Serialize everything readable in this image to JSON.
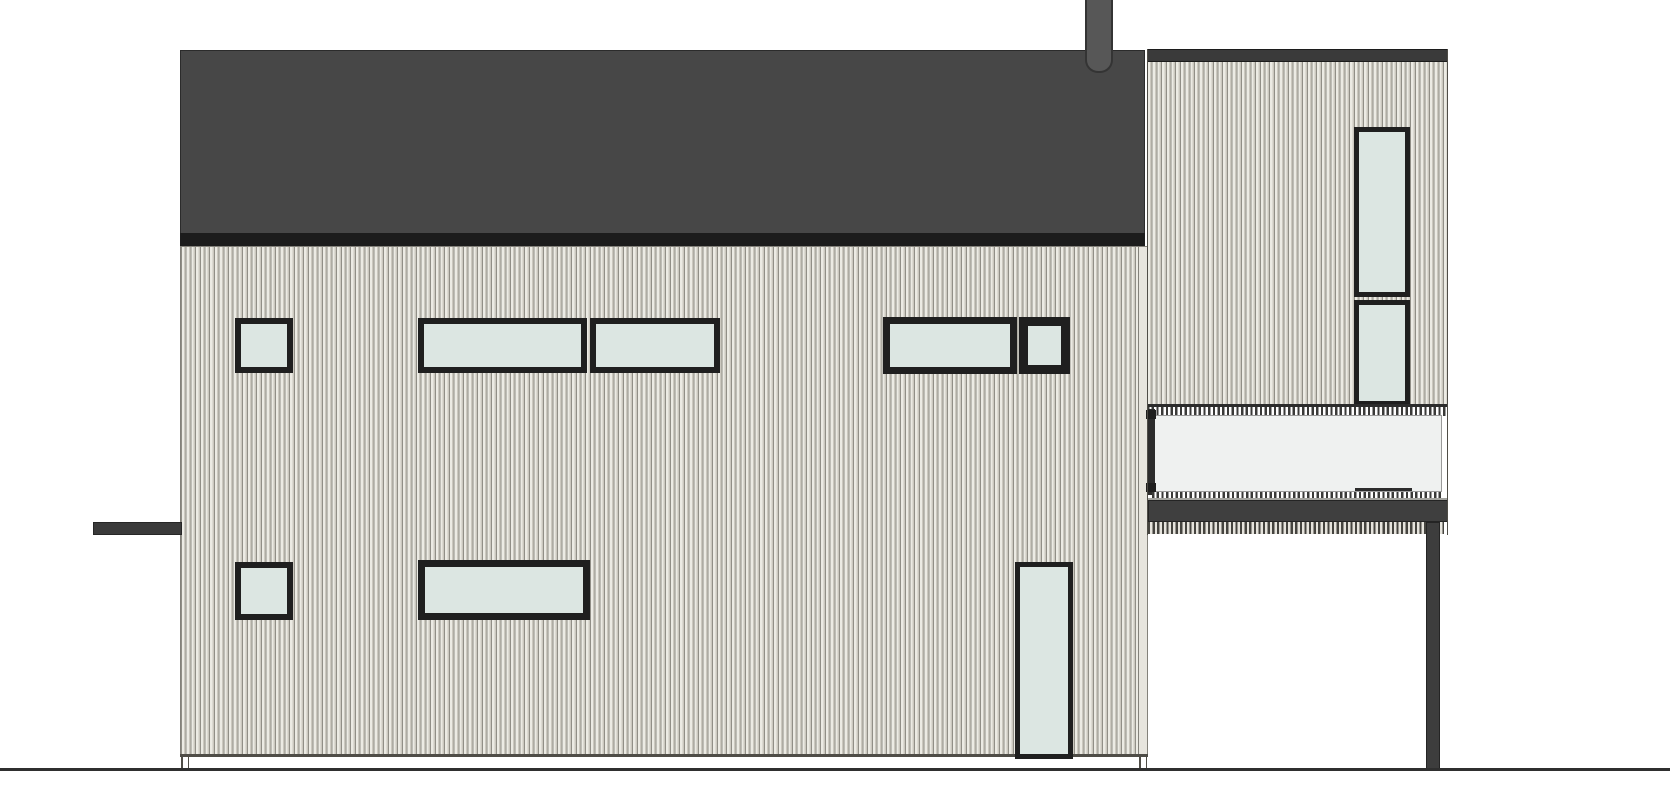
{
  "drawing": {
    "kind": "house-side-elevation",
    "canvas": {
      "width": 1670,
      "height": 800
    }
  },
  "colors": {
    "background": "#ffffff",
    "roof": "#474747",
    "roof_outline": "#2b2b2b",
    "fascia": "#1c1c1c",
    "dark_band": "#3a3a3a",
    "beam_outline": "#262626",
    "chimney": "#575757",
    "chimney_outline": "#343434",
    "wall_outline": "#83817a",
    "edge_dark": "#4f4d47",
    "corner_board": "#e7e5de",
    "window_frame": "#1f1f1f",
    "glass": "#dce6e2",
    "balcony_glass": "#eff1f0",
    "panel_edge": "#9a9a9a",
    "rail_dark": "#2c2c2c",
    "slab": "#3f3f3f",
    "slab_highlight": "#a3a39e",
    "post": "#3d3d3d",
    "post_outline": "#242424",
    "ground": "#2f2f2f",
    "white": "#ffffff",
    "siding_groove": "#918f87",
    "siding_light": "#ecebe4",
    "siding_shadow": "#cbc8bf"
  },
  "scene": {
    "elements": [
      {
        "name": "main-roof",
        "type": "rect",
        "x": 180,
        "y": 50,
        "w": 965,
        "h": 185,
        "fill": "roof",
        "line": "roof_outline",
        "lw": 1.5
      },
      {
        "name": "main-roof-fascia",
        "type": "rect",
        "x": 180,
        "y": 233,
        "w": 965,
        "h": 13,
        "fill": "fascia"
      },
      {
        "name": "main-facade-siding",
        "type": "siding",
        "x": 180,
        "y": 246,
        "w": 968,
        "h": 510,
        "line": "wall_outline",
        "lw": 1
      },
      {
        "name": "facade-corner-board",
        "type": "rect",
        "x": 1138,
        "y": 246,
        "w": 10,
        "h": 510,
        "fill": "corner_board",
        "line": "wall_outline",
        "lw": 1
      },
      {
        "name": "facade-bottom-edge",
        "type": "rect",
        "x": 180,
        "y": 754,
        "w": 968,
        "h": 2.5,
        "fill": "edge_dark"
      },
      {
        "name": "window-upper-square-left",
        "type": "window",
        "x": 235,
        "y": 318,
        "w": 58,
        "h": 55,
        "f": 6
      },
      {
        "name": "window-upper-wide-left-a",
        "type": "window",
        "x": 418,
        "y": 318,
        "w": 169,
        "h": 55,
        "f": 6
      },
      {
        "name": "window-upper-wide-left-b",
        "type": "window",
        "x": 590,
        "y": 318,
        "w": 130,
        "h": 55,
        "f": 6
      },
      {
        "name": "window-upper-wide-right",
        "type": "window",
        "x": 883,
        "y": 317,
        "w": 134,
        "h": 57,
        "f": 7
      },
      {
        "name": "window-upper-square-right",
        "type": "window",
        "x": 1019,
        "y": 317,
        "w": 51,
        "h": 57,
        "f": 9
      },
      {
        "name": "window-lower-square-left",
        "type": "window",
        "x": 235,
        "y": 562,
        "w": 58,
        "h": 58,
        "f": 6
      },
      {
        "name": "window-lower-wide",
        "type": "window",
        "x": 418,
        "y": 560,
        "w": 172,
        "h": 60,
        "f": 7
      },
      {
        "name": "window-lower-tall",
        "type": "window",
        "x": 1015,
        "y": 562,
        "w": 58,
        "h": 197,
        "f": 5
      },
      {
        "name": "left-beam",
        "type": "rect",
        "x": 93,
        "y": 522,
        "w": 89,
        "h": 13,
        "fill": "dark_band",
        "line": "beam_outline",
        "lw": 1
      },
      {
        "name": "roof-pipe-chimney",
        "type": "chimney",
        "x": 1085,
        "y": 0,
        "w": 28,
        "h": 73
      },
      {
        "name": "foundation-notch-left-a",
        "type": "rect",
        "x": 181,
        "y": 755,
        "w": 1.5,
        "h": 14,
        "fill": "edge_dark"
      },
      {
        "name": "foundation-notch-left-b",
        "type": "rect",
        "x": 187.5,
        "y": 755,
        "w": 1.5,
        "h": 14,
        "fill": "edge_dark"
      },
      {
        "name": "foundation-notch-right-a",
        "type": "rect",
        "x": 1139,
        "y": 755,
        "w": 1.5,
        "h": 14,
        "fill": "edge_dark"
      },
      {
        "name": "foundation-notch-right-b",
        "type": "rect",
        "x": 1145.5,
        "y": 755,
        "w": 1.5,
        "h": 14,
        "fill": "edge_dark"
      },
      {
        "name": "wing-top-band",
        "type": "rect",
        "x": 1147,
        "y": 49,
        "w": 301,
        "h": 13,
        "fill": "dark_band",
        "line": "fascia",
        "lw": 1
      },
      {
        "name": "wing-wall-siding",
        "type": "siding",
        "x": 1147,
        "y": 62,
        "w": 301,
        "h": 344
      },
      {
        "name": "wing-window-upper",
        "type": "window",
        "x": 1354,
        "y": 127,
        "w": 56,
        "h": 170,
        "f": 5
      },
      {
        "name": "wing-window-lower",
        "type": "window",
        "x": 1354,
        "y": 300,
        "w": 56,
        "h": 106,
        "f": 5
      },
      {
        "name": "balcony-backdrop",
        "type": "rect",
        "x": 1148,
        "y": 405,
        "w": 300,
        "h": 95,
        "fill": "white"
      },
      {
        "name": "balcony-rail-top",
        "type": "rect",
        "x": 1147,
        "y": 404,
        "w": 301,
        "h": 2.5,
        "fill": "rail_dark"
      },
      {
        "name": "balcony-ticks-top",
        "type": "ticks",
        "x": 1147,
        "y": 407,
        "w": 301,
        "h": 8.5
      },
      {
        "name": "balcony-glass-panel",
        "type": "rect",
        "x": 1152,
        "y": 415,
        "w": 290,
        "h": 77,
        "fill": "balcony_glass",
        "line": "panel_edge",
        "lw": 1
      },
      {
        "name": "balcony-left-stile",
        "type": "rect",
        "x": 1148,
        "y": 409,
        "w": 7,
        "h": 86,
        "fill": "rail_dark"
      },
      {
        "name": "balcony-bracket-top",
        "type": "rect",
        "x": 1146,
        "y": 410,
        "w": 10,
        "h": 9,
        "fill": "window_frame"
      },
      {
        "name": "balcony-bracket-bottom",
        "type": "rect",
        "x": 1146,
        "y": 483,
        "w": 10,
        "h": 9,
        "fill": "window_frame"
      },
      {
        "name": "balcony-sill-line",
        "type": "rect",
        "x": 1355,
        "y": 488,
        "w": 57,
        "h": 3,
        "fill": "rail_dark"
      },
      {
        "name": "balcony-ticks-bottom",
        "type": "ticks",
        "x": 1152,
        "y": 492,
        "w": 290,
        "h": 8
      },
      {
        "name": "balcony-slab-highlight",
        "type": "rect",
        "x": 1148,
        "y": 498,
        "w": 300,
        "h": 2,
        "fill": "slab_highlight"
      },
      {
        "name": "balcony-slab",
        "type": "rect",
        "x": 1148,
        "y": 500,
        "w": 300,
        "h": 22,
        "fill": "slab",
        "line": "post_outline",
        "lw": 1
      },
      {
        "name": "wing-soffit-hatch",
        "type": "soffit",
        "x": 1148,
        "y": 522,
        "w": 296,
        "h": 12
      },
      {
        "name": "wing-left-edge",
        "type": "rect",
        "x": 1146.5,
        "y": 49,
        "w": 1.5,
        "h": 486,
        "fill": "edge_dark"
      },
      {
        "name": "wing-right-edge",
        "type": "rect",
        "x": 1446.5,
        "y": 49,
        "w": 1.5,
        "h": 486,
        "fill": "edge_dark"
      },
      {
        "name": "support-post",
        "type": "rect",
        "x": 1426,
        "y": 522,
        "w": 14,
        "h": 247,
        "fill": "post",
        "line": "post_outline",
        "lw": 1
      },
      {
        "name": "ground-line",
        "type": "rect",
        "x": 0,
        "y": 768,
        "w": 1670,
        "h": 2.5,
        "fill": "ground"
      }
    ]
  }
}
